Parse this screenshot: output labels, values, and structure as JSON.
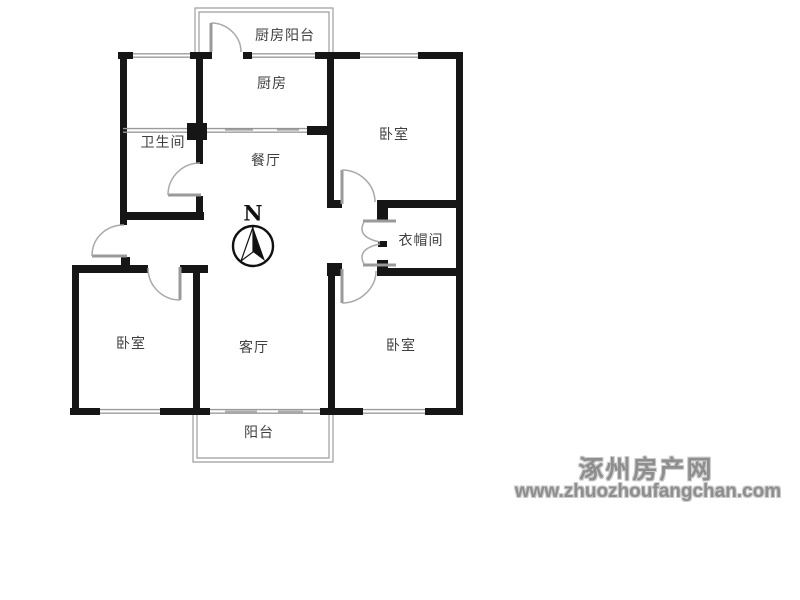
{
  "floor_plan": {
    "compass": {
      "north_label": "N"
    },
    "rooms": {
      "kitchen_balcony": "厨房阳台",
      "kitchen": "厨房",
      "bathroom": "卫生间",
      "dining_room": "餐厅",
      "bedroom_top_right": "卧室",
      "cloakroom": "衣帽间",
      "bedroom_bottom_left": "卧室",
      "living_room": "客厅",
      "bedroom_bottom_right": "卧室",
      "balcony": "阳台"
    },
    "colors": {
      "wall": "#161616",
      "window_line": "#9b9b9b",
      "door_line": "#a9a9a9",
      "label_text": "#3f3f3f"
    }
  },
  "watermark": {
    "site_name": "涿州房产网",
    "site_url": "www.zhuozhoufangchan.com",
    "color": "#8e8e8e"
  }
}
